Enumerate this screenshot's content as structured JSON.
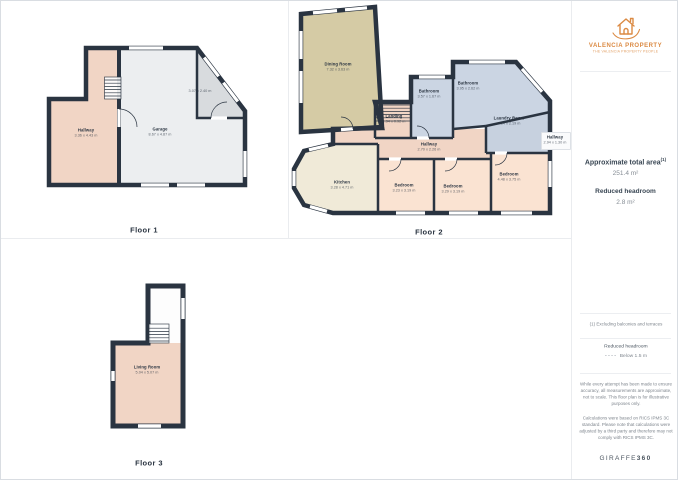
{
  "palette": {
    "wall": "#2A3441",
    "hallway": "#F1D5C5",
    "bedroom": "#FAE3D2",
    "kitchen": "#F0EAD8",
    "dining": "#D5CBA5",
    "bath": "#CBD5E3",
    "laundry": "#C7D1DF",
    "garage": "#ECEEF0",
    "store": "#D8DBDE",
    "living": "#F1D5C5",
    "brand_orange": "#DB8A43"
  },
  "floors": {
    "floor1": {
      "label": "Floor 1",
      "rooms": [
        {
          "name": "Hallway",
          "dims": "3.36 x 4.43 m"
        },
        {
          "name": "Garage",
          "dims": "8.67 x 4.87 m"
        },
        {
          "name": "",
          "dims": "3.07 x 2.40 m"
        }
      ]
    },
    "floor2": {
      "label": "Floor 2",
      "rooms": [
        {
          "name": "Dining Room",
          "dims": "7.32 x 3.63 m"
        },
        {
          "name": "Landing",
          "dims": "1.94 x 0.92 m"
        },
        {
          "name": "Bathroom",
          "dims": "3.57 x 1.67 m"
        },
        {
          "name": "Bathroom",
          "dims": "3.95 x 2.62 m"
        },
        {
          "name": "Laundry Room",
          "dims": "4.14 x 2.19 m"
        },
        {
          "name": "Hallway",
          "dims": "2.70 x 2.26 m"
        },
        {
          "name": "Hallway",
          "dims": "2.94 x 1.30 m"
        },
        {
          "name": "Kitchen",
          "dims": "3.28 x 4.71 m"
        },
        {
          "name": "Bedroom",
          "dims": "3.23 x 3.19 m"
        },
        {
          "name": "Bedroom",
          "dims": "3.29 x 3.19 m"
        },
        {
          "name": "Bedroom",
          "dims": "4.48 x 3.75 m"
        }
      ]
    },
    "floor3": {
      "label": "Floor 3",
      "rooms": [
        {
          "name": "Living Room",
          "dims": "5.04 x 5.07 m"
        }
      ]
    }
  },
  "sidebar": {
    "brand_name": "VALENCIA PROPERTY",
    "brand_tagline": "THE VALENCIA PROPERTY PEOPLE",
    "area_title": "Approximate total area",
    "area_sup": "(1)",
    "area_value": "251.4 m²",
    "headroom_title": "Reduced headroom",
    "headroom_value": "2.8 m²",
    "footnote": "(1) Excluding balconies and terraces",
    "legend_title": "Reduced headroom",
    "legend_value": "Below 1.5 m",
    "disclaimer_1": "While every attempt has been made to ensure accuracy, all measurements are approximate, not to scale. This floor plan is for illustrative purposes only.",
    "disclaimer_2": "Calculations were based on RICS IPMS 3C standard. Please note that calculations were adjusted by a third party and therefore may not comply with RICS IPMS 3C.",
    "brand_footer_1": "GIRAFFE",
    "brand_footer_2": "360"
  }
}
